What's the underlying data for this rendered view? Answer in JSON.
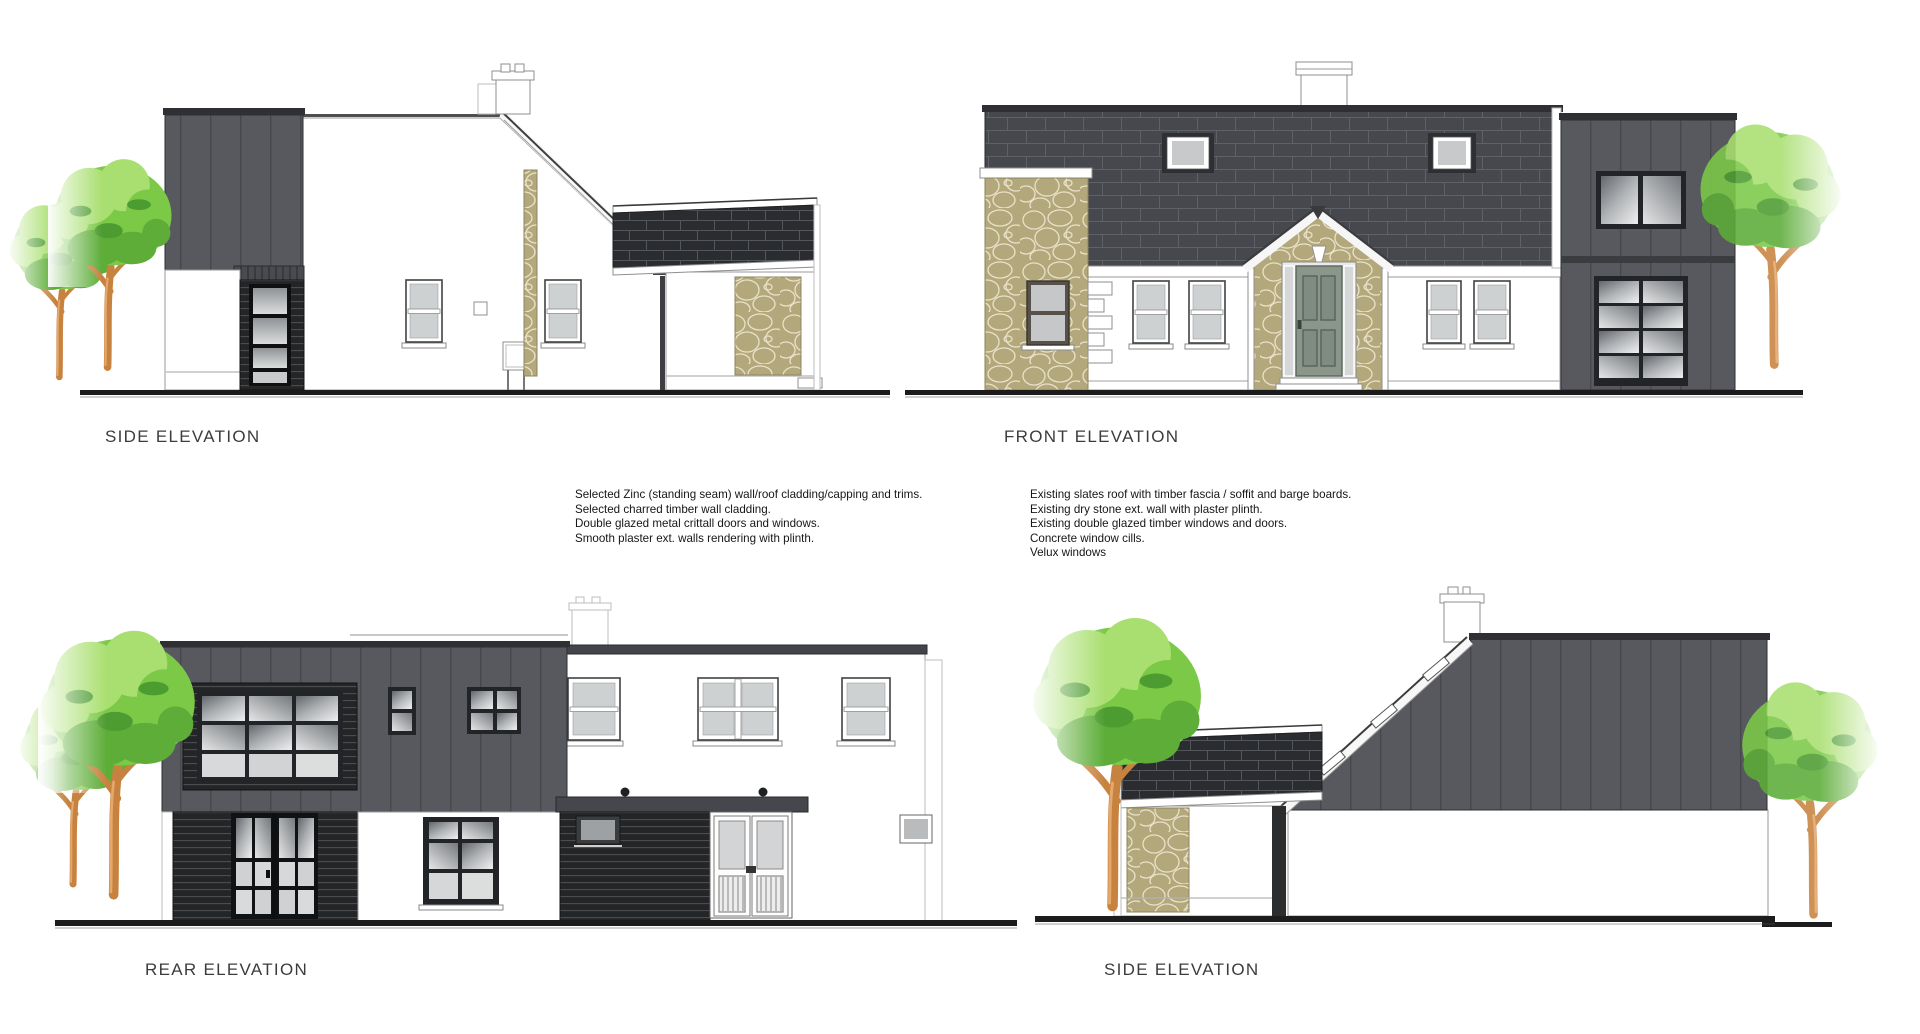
{
  "sheet": {
    "background": "#ffffff"
  },
  "labels": {
    "top_left": "SIDE ELEVATION",
    "top_right": "FRONT ELEVATION",
    "bottom_left": "REAR ELEVATION",
    "bottom_right": "SIDE ELEVATION"
  },
  "notes": {
    "proposed": {
      "lines": [
        "Selected Zinc (standing seam) wall/roof cladding/capping and trims.",
        "Selected charred timber wall cladding.",
        "Double glazed metal crittall doors and windows.",
        "Smooth plaster ext. walls rendering with plinth."
      ]
    },
    "existing": {
      "lines": [
        "Existing slates roof with timber fascia / soffit and barge boards.",
        "Existing dry stone ext. wall with plaster plinth.",
        "Existing double glazed timber windows and doors.",
        "Concrete window cills.",
        "Velux windows"
      ]
    }
  },
  "colors": {
    "zinc": "#58595e",
    "zinc_dark": "#46474b",
    "capping": "#2f3033",
    "slate_dark": "#2a2c2f",
    "slate_mid": "#46484d",
    "stone": "#b3a87c",
    "stone_mortar": "#e9e2c8",
    "charred": "#232527",
    "door_sage": "#8a9689",
    "glass_light": "#ced1d2",
    "tree_light": "#a9df70",
    "tree_mid": "#7cc948",
    "tree_dark": "#5dad38",
    "tree_accent": "#4d9c31",
    "trunk": "#c8823f",
    "trunk_highlight": "#e9af72",
    "ground": "#1c1c1c",
    "label_text": "#3c3c3c"
  }
}
